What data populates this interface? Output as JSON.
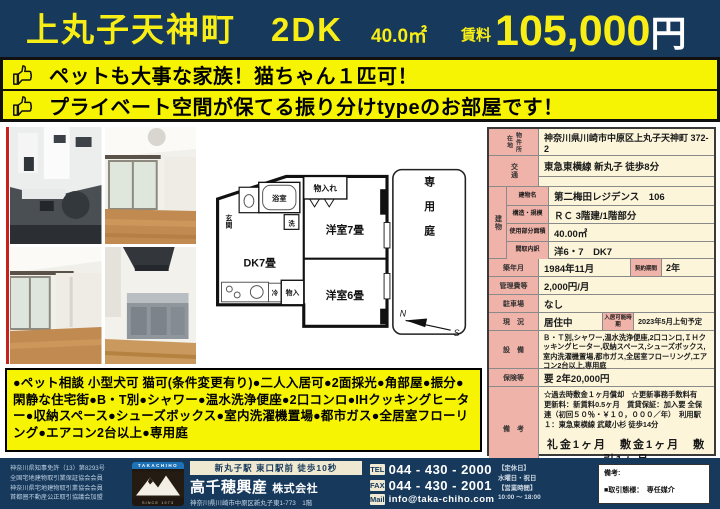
{
  "header": {
    "title": "上丸子天神町　2DK",
    "area": "40.0㎡",
    "rent_label": "賃料",
    "rent_value": "105,000",
    "rent_unit": "円"
  },
  "banner": {
    "lines": [
      "ペットも大事な家族！猫ちゃん１匹可！",
      "プライベート空間が保てる振り分けtypeのお部屋です！"
    ]
  },
  "floorplan": {
    "genkan": "玄関",
    "bath": "浴室",
    "wash": "洗",
    "closet_top": "物入れ",
    "room7": "洋室7畳",
    "dk": "DK7畳",
    "fridge": "冷",
    "closet_bottom": "物入",
    "room6": "洋室6畳",
    "garden": "専用庭",
    "compass_n": "N",
    "compass_s": "S"
  },
  "table": {
    "location_label": "物件所在地",
    "location": "神奈川県川崎市中原区上丸子天神町 372-2",
    "access_label": "交通",
    "access": "東急東横線 新丸子 徒歩8分",
    "building_label": "建物",
    "building_name_label": "建物名",
    "building_name": "第二梅田レジデンス　106",
    "structure_label": "構造・規模",
    "structure": "ＲＣ 3階建/1階部分",
    "floor_area_label": "使用部分面積",
    "floor_area": "40.00㎡",
    "layout_label": "間取内訳",
    "layout": "洋6・7　DK7",
    "built_label": "築年月",
    "built": "1984年11月",
    "contract_label": "契約期間",
    "contract": "2年",
    "mgmt_label": "管理費等",
    "mgmt": "2,000円/月",
    "parking_label": "駐車場",
    "parking": "なし",
    "status_label": "現　況",
    "status": "居住中",
    "movein_label": "入居可能時期",
    "movein": "2023年5月上旬予定",
    "equipment_label": "設　備",
    "equipment": "Ｂ・Ｔ別,シャワー,温水洗浄便座,2口コンロ,ＩＨクッキングヒーター,収納スペース,シューズボックス,室内洗濯機置場,都市ガス,全居室フローリング,エアコン2台以上,専用庭",
    "insurance_label": "保険等",
    "insurance": "要 2年20,000円",
    "remarks_label": "備　考",
    "remarks_line1": "☆過去時敷金１ヶ月償却　☆更新事務手数料有",
    "remarks_line2": "更新料：新賃料0.5ヶ月　賃貸保証：加入要 全保連（初回５０％・￥１０，０００／年）　利用駅１：東急東横線 武蔵小杉 徒歩14分",
    "remarks_fees": "礼金1ヶ月　敷金1ヶ月　敷引1ヶ月"
  },
  "features": "●ペット相談 小型犬可 猫可(条件変更有り)●二人入居可●2面採光●角部屋●振分●閑静な住宅街●B・T別●シャワー●温水洗浄便座●2口コンロ●IHクッキングヒーター●収納スペース●シューズボックス●室内洗濯機置場●都市ガス●全居室フローリング●エアコン2台以上●専用庭",
  "footer": {
    "licenses": [
      "神奈川県知事免許（13）第8293号",
      "全国宅地建物取引業保証協会会員",
      "神奈川県宅地建物取引業協会会員",
      "首都圏不動産公正取引協議会加盟"
    ],
    "logo_top": "TAKACHIHO",
    "logo_bottom": "SINCE 1973",
    "access": "新丸子駅 東口駅前 徒歩10秒",
    "company_name": "高千穂興産",
    "company_suffix": "株式会社",
    "address": "神奈川県川崎市中原区新丸子東1-773　1階",
    "contacts": [
      {
        "label": "TEL",
        "value": "044 - 430 - 2000"
      },
      {
        "label": "FAX",
        "value": "044 - 430 - 2001"
      },
      {
        "label": "Mail",
        "value": "info@taka-chiho.com"
      }
    ],
    "hours": [
      "【定休日】",
      "水曜日・祝日",
      "【営業時間】",
      "10:00 ～ 18:00"
    ],
    "remark_label": "備考:",
    "remark_text": "■取引態様：　専任媒介"
  }
}
